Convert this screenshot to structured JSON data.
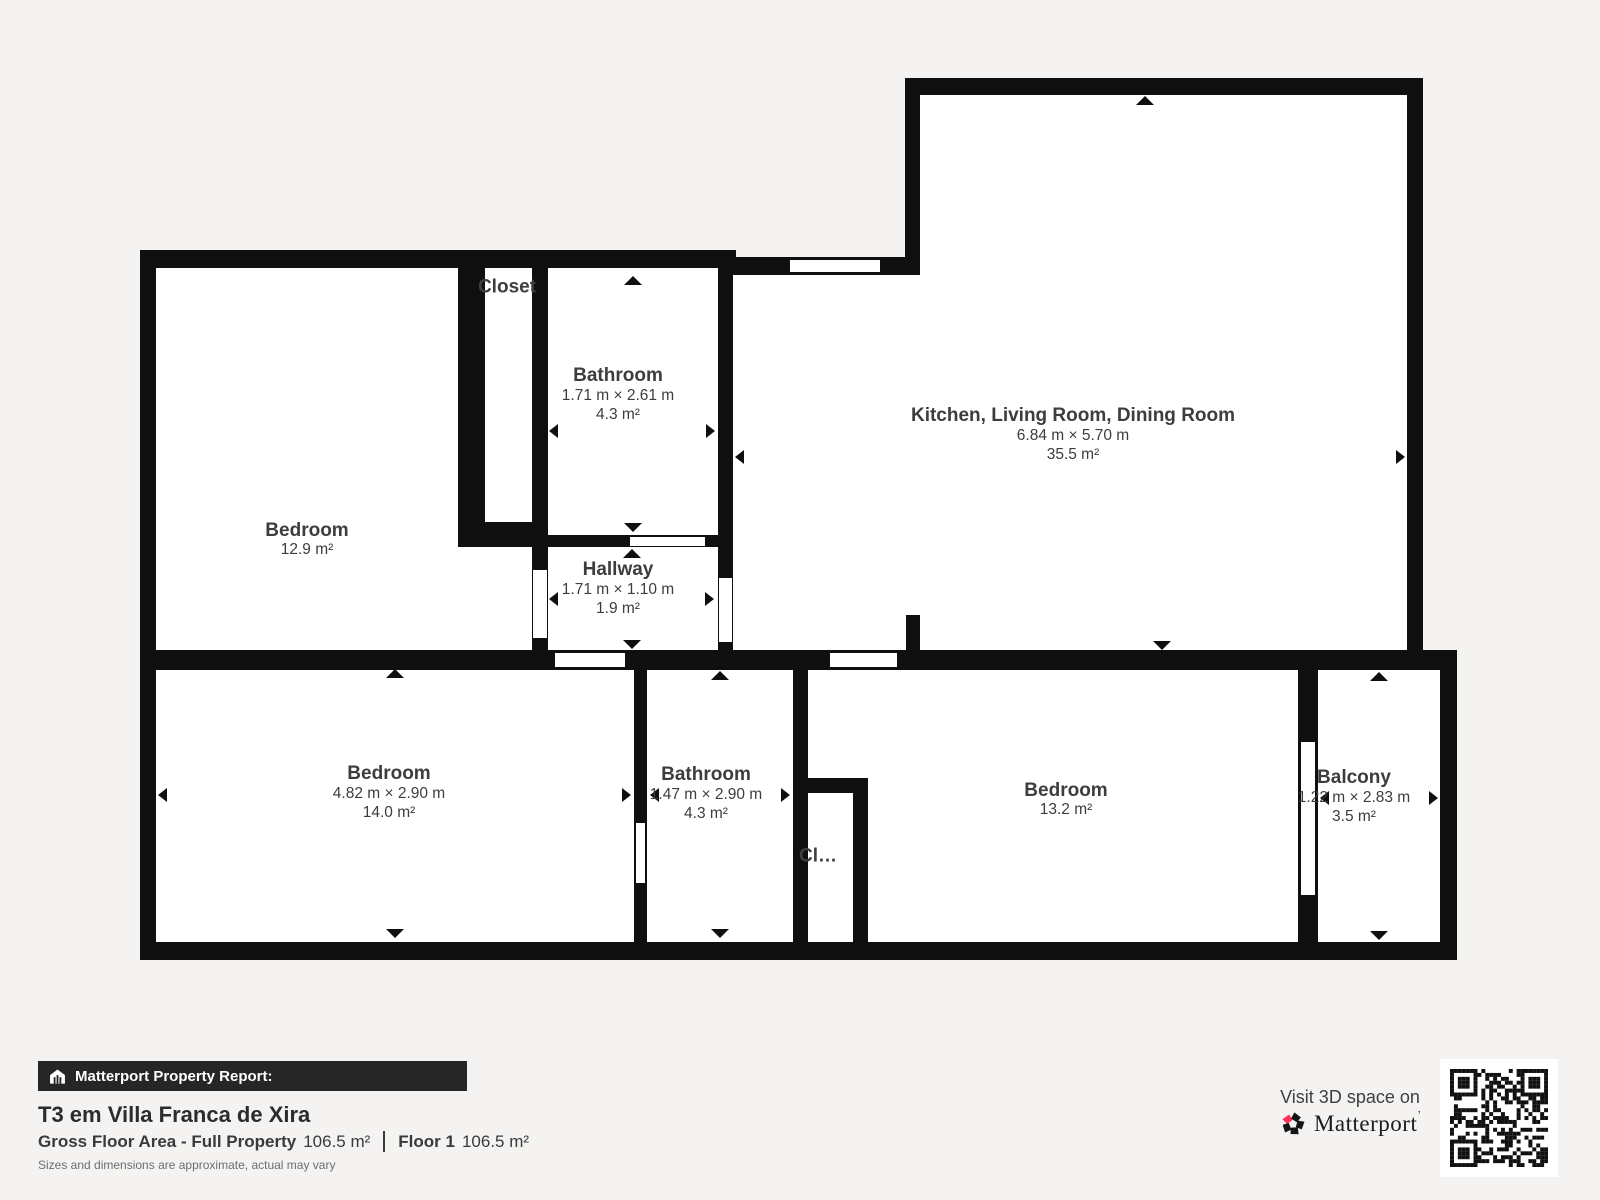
{
  "plan": {
    "rooms": {
      "bedroom_tl": {
        "name": "Bedroom",
        "area": "12.9 m²"
      },
      "closet_top": {
        "name": "Closet"
      },
      "bathroom_top": {
        "name": "Bathroom",
        "dims": "1.71 m × 2.61 m",
        "area": "4.3 m²"
      },
      "hallway": {
        "name": "Hallway",
        "dims": "1.71 m × 1.10 m",
        "area": "1.9 m²"
      },
      "kitchen_living_dining": {
        "name": "Kitchen, Living Room, Dining Room",
        "dims": "6.84 m × 5.70 m",
        "area": "35.5 m²"
      },
      "bedroom_bl": {
        "name": "Bedroom",
        "dims": "4.82 m × 2.90 m",
        "area": "14.0 m²"
      },
      "bathroom_bottom": {
        "name": "Bathroom",
        "dims": "1.47 m × 2.90 m",
        "area": "4.3 m²"
      },
      "closet_bottom": {
        "name": "Cl…"
      },
      "bedroom_br": {
        "name": "Bedroom",
        "area": "13.2 m²"
      },
      "balcony": {
        "name": "Balcony",
        "dims": "1.22 m × 2.83 m",
        "area": "3.5 m²"
      }
    }
  },
  "report": {
    "header": "Matterport Property Report:",
    "title": "T3 em Villa Franca de Xira",
    "gross_label": "Gross Floor Area - Full Property",
    "gross_value": "106.5 m²",
    "floor_label": "Floor 1",
    "floor_value": "106.5 m²",
    "disclaimer": "Sizes and dimensions are approximate, actual may vary"
  },
  "promo": {
    "visit": "Visit 3D space on",
    "brand": "Matterport",
    "mark": "’"
  },
  "colors": {
    "background": "#f4f3f1",
    "wall": "#0f0f0f",
    "text": "#3d3d3d",
    "accent": "#ff3158"
  }
}
